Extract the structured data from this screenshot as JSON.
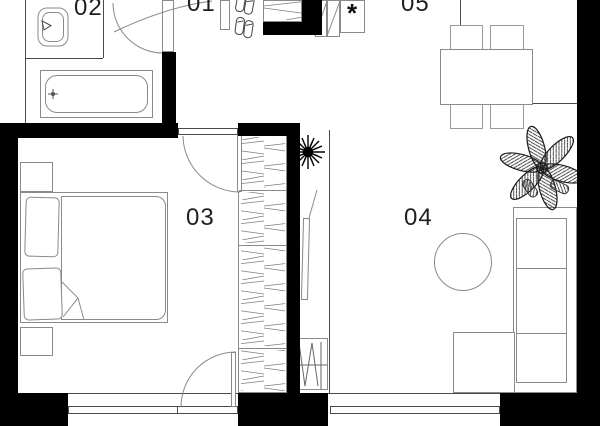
{
  "plan": {
    "title": "apartment-floor-plan",
    "colors": {
      "background": "#ffffff",
      "wall": "#000000",
      "furniture_line": "#8a8a8a",
      "thin_wall_line": "#4a4a4a",
      "label": "#1f1f1f"
    },
    "rooms": [
      {
        "id": "01",
        "label": "01",
        "name": "entrance-hall",
        "furniture": [
          "shoe-pairs",
          "hanging-closet",
          "panel-closet",
          "utility-cabinet"
        ]
      },
      {
        "id": "02",
        "label": "02",
        "name": "bathroom",
        "furniture": [
          "toilet",
          "bathtub"
        ]
      },
      {
        "id": "03",
        "label": "03",
        "name": "bedroom",
        "furniture": [
          "double-bed",
          "pillows",
          "nightstand-top",
          "nightstand-bottom",
          "wardrobe-column"
        ]
      },
      {
        "id": "04",
        "label": "04",
        "name": "living-room",
        "furniture": [
          "wall-tv",
          "radiator",
          "round-coffee-table",
          "corner-sofa",
          "slippers",
          "plant-small",
          "plant-large"
        ]
      },
      {
        "id": "05",
        "label": "05",
        "name": "dining-area",
        "furniture": [
          "dining-table",
          "four-chairs"
        ]
      }
    ],
    "symbols": {
      "utility_marker": "*"
    }
  }
}
